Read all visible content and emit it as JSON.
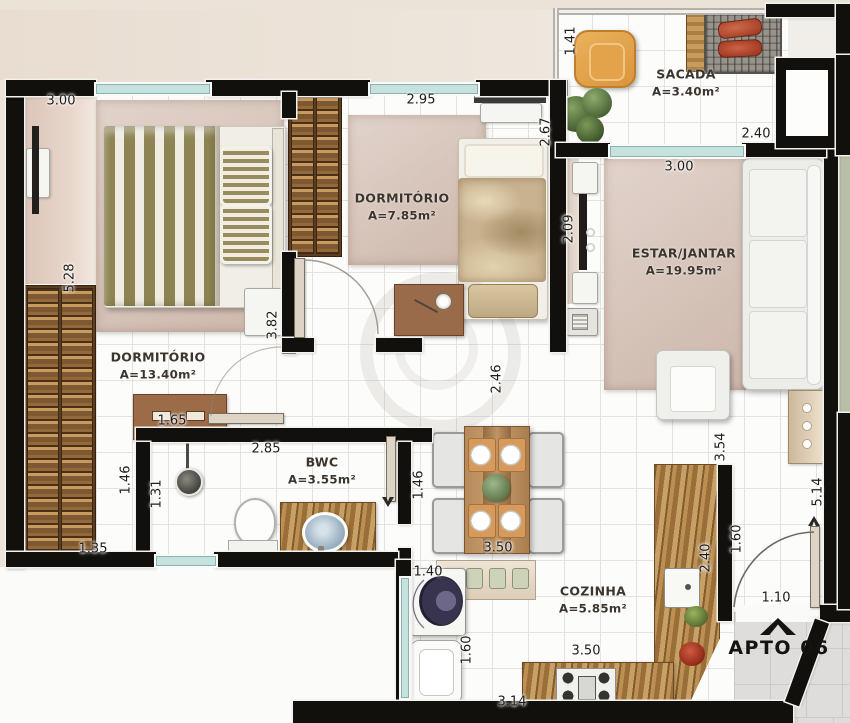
{
  "plan_title": "APTO 06",
  "rooms": {
    "dormitorio1": {
      "name": "DORMITÓRIO",
      "area": "A=13.40m²"
    },
    "dormitorio2": {
      "name": "DORMITÓRIO",
      "area": "A=7.85m²"
    },
    "sacada": {
      "name": "SACADA",
      "area": "A=3.40m²"
    },
    "estar_jantar": {
      "name": "ESTAR/JANTAR",
      "area": "A=19.95m²"
    },
    "bwc": {
      "name": "BWC",
      "area": "A=3.55m²"
    },
    "cozinha": {
      "name": "COZINHA",
      "area": "A=5.85m²"
    }
  },
  "dims": {
    "dorm1_top": "3.00",
    "dorm1_left": "5.28",
    "dorm1_right": "3.82",
    "dorm1_dresser": "1.65",
    "dorm2_top": "2.95",
    "dorm2_right": "2.67",
    "sacada_left": "1.41",
    "sacada_right": "2.40",
    "estar_top": "3.00",
    "estar_left": "2.09",
    "bwc_top": "2.85",
    "nook_width": "1.46",
    "shower_width": "1.31",
    "nook_bottom": "1.35",
    "corridor_right": "1.46",
    "hall_height": "2.46",
    "dining_bottom": "3.50",
    "laundry_top": "1.40",
    "laundry_left": "1.60",
    "kitchen_top": "3.50",
    "kitchen_bottom": "3.14",
    "kitchen_counter": "2.40",
    "hall_right_upper": "3.54",
    "hall_right_lower": "1.60",
    "entry_side": "5.14",
    "entry_door": "1.10"
  },
  "colors": {
    "wall": "#12100d",
    "window_glass": "#c6e2df",
    "floor_tile": "#fcfcfb",
    "rug": "#d8c5ba",
    "wood_wardrobe": "#93683a",
    "granite": "#b28347",
    "chair_orange": "#e2a049",
    "plant_green": "#55713f",
    "grill_meat": "#b84a30",
    "corridor_gray": "#dedddb",
    "blanket_stripe": "#8e8453"
  }
}
